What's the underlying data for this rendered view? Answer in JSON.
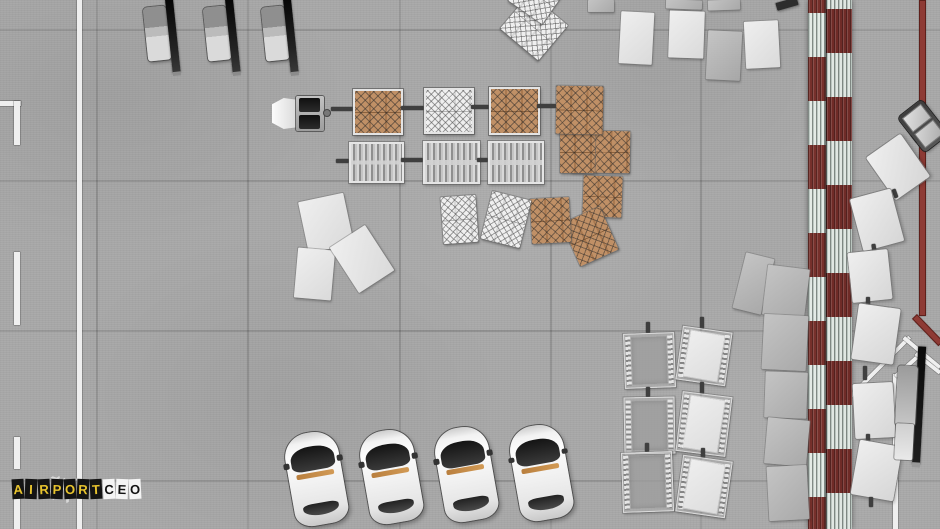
{
  "game": {
    "title_word1": "AIRPORT",
    "title_word2": "CEO"
  },
  "logo": {
    "word1": "AIRPORT",
    "word2": "CEO",
    "tile1_bg": "#141414",
    "tile1_fg": "#e8c42e",
    "tile2_bg": "#f4f4f4",
    "tile2_fg": "#121212",
    "plane_icon": "airplane-icon"
  },
  "colors": {
    "apron_concrete": "#a8a8a8",
    "marking_white": "#efefef",
    "zone_border_red": "#8e3b35",
    "roof_red": "#76302b",
    "roof_panel_white": "#e4ebe6",
    "cargo_brown": "#b98a60",
    "cargo_net": "#3c3c3c",
    "vehicle_belt_black": "#111111",
    "vehicle_silver": "#c6c6c6",
    "car_white": "#f2f2f2",
    "car_trim_amber": "#c68b46"
  },
  "scene": {
    "width": 940,
    "height": 529,
    "seams": {
      "v": [
        96,
        247,
        399,
        550,
        700
      ],
      "h": [
        29,
        180,
        330,
        480
      ]
    },
    "objects": [
      {
        "t": "line_w",
        "x": 77,
        "y": 0,
        "w": 5,
        "h": 529
      },
      {
        "t": "line_w",
        "x": 0,
        "y": 101,
        "w": 21,
        "h": 5
      },
      {
        "t": "line_w",
        "x": 14,
        "y": 101,
        "w": 6,
        "h": 44
      },
      {
        "t": "line_w",
        "x": 14,
        "y": 252,
        "w": 6,
        "h": 73
      },
      {
        "t": "line_w",
        "x": 14,
        "y": 437,
        "w": 6,
        "h": 32
      },
      {
        "t": "line_w",
        "x": 14,
        "y": 498,
        "w": 6,
        "h": 31
      },
      {
        "t": "line_w",
        "x": 845,
        "y": 396,
        "w": 5,
        "h": 133
      },
      {
        "t": "line_w",
        "x": 846,
        "y": 398,
        "w": 88,
        "h": 4,
        "r": -45
      },
      {
        "t": "line_w",
        "x": 905,
        "y": 336,
        "w": 47,
        "h": 4,
        "r": 39.8
      },
      {
        "t": "line_w",
        "x": 893,
        "y": 374,
        "w": 5,
        "h": 155
      },
      {
        "t": "line_w",
        "x": 894,
        "y": 375,
        "w": 35,
        "h": 4,
        "r": -41.5
      },
      {
        "t": "line_w",
        "x": 917,
        "y": 352,
        "w": 31,
        "h": 4,
        "r": 38.4
      },
      {
        "t": "line_r",
        "x": 919,
        "y": 0,
        "w": 7,
        "h": 316
      },
      {
        "t": "line_r",
        "x": 917,
        "y": 314,
        "w": 38,
        "h": 7,
        "r": 46
      },
      {
        "t": "wall",
        "x": 808,
        "y": 0,
        "w": 44,
        "h": 529
      },
      {
        "t": "pallet_plain",
        "v": "gray",
        "x": 588,
        "y": 0,
        "w": 26,
        "h": 12
      },
      {
        "t": "pallet_plain",
        "v": "gray",
        "x": 666,
        "y": 0,
        "w": 36,
        "h": 9,
        "r": 2
      },
      {
        "t": "pallet_plain",
        "v": "gray",
        "x": 708,
        "y": 0,
        "w": 32,
        "h": 10,
        "r": -2
      },
      {
        "t": "pallet_plain",
        "v": "dark",
        "x": 776,
        "y": 0,
        "w": 22,
        "h": 8,
        "r": -16
      },
      {
        "t": "pallet_plain",
        "v": "white",
        "x": 620,
        "y": 12,
        "w": 33,
        "h": 52,
        "r": 3
      },
      {
        "t": "pallet_plain",
        "v": "white",
        "x": 669,
        "y": 11,
        "w": 35,
        "h": 47,
        "r": 2
      },
      {
        "t": "pallet_plain",
        "v": "faint",
        "x": 707,
        "y": 31,
        "w": 34,
        "h": 49,
        "r": 3
      },
      {
        "t": "pallet_plain",
        "v": "white",
        "x": 745,
        "y": 21,
        "w": 34,
        "h": 47,
        "r": -3
      },
      {
        "t": "pallet_plain",
        "v": "gray",
        "x": 739,
        "y": 255,
        "w": 29,
        "h": 57,
        "r": 14
      },
      {
        "t": "pallet_plain",
        "v": "gray",
        "x": 765,
        "y": 267,
        "w": 42,
        "h": 50,
        "r": 7
      },
      {
        "t": "pallet_plain",
        "v": "gray",
        "x": 763,
        "y": 315,
        "w": 44,
        "h": 55,
        "r": 3
      },
      {
        "t": "pallet_plain",
        "v": "gray",
        "x": 765,
        "y": 372,
        "w": 42,
        "h": 46,
        "r": 2
      },
      {
        "t": "pallet_plain",
        "v": "gray",
        "x": 766,
        "y": 419,
        "w": 42,
        "h": 46,
        "r": 5
      },
      {
        "t": "pallet_plain",
        "v": "gray",
        "x": 768,
        "y": 466,
        "w": 40,
        "h": 54,
        "r": -3
      },
      {
        "t": "pallet_plain",
        "v": "white",
        "x": 303,
        "y": 197,
        "w": 46,
        "h": 52,
        "r": -12
      },
      {
        "t": "pallet_plain",
        "v": "white",
        "x": 296,
        "y": 249,
        "w": 37,
        "h": 50,
        "r": 5
      },
      {
        "t": "pallet_plain",
        "v": "white",
        "x": 341,
        "y": 232,
        "w": 42,
        "h": 54,
        "r": -33
      },
      {
        "t": "pallet_plain",
        "v": "white",
        "x": 571,
        "y": 153,
        "w": 23,
        "h": 20,
        "r": 3
      },
      {
        "t": "pallet_net",
        "v": "white",
        "x": 509,
        "y": 4,
        "w": 50,
        "h": 46,
        "r": 40
      },
      {
        "t": "pallet_net",
        "v": "white",
        "x": 516,
        "y": -26,
        "w": 42,
        "h": 42,
        "r": 35
      },
      {
        "t": "pallet_net",
        "v": "brown",
        "x": 560,
        "y": 131,
        "w": 37,
        "h": 42
      },
      {
        "t": "pallet_net",
        "v": "brown",
        "x": 596,
        "y": 131,
        "w": 34,
        "h": 42,
        "r": 1
      },
      {
        "t": "pallet_net",
        "v": "brown",
        "x": 583,
        "y": 176,
        "w": 39,
        "h": 41,
        "r": 2
      },
      {
        "t": "pallet_net",
        "v": "brown",
        "x": 569,
        "y": 213,
        "w": 42,
        "h": 47,
        "r": -24
      },
      {
        "t": "pallet_net",
        "v": "brown",
        "x": 531,
        "y": 198,
        "w": 39,
        "h": 45,
        "r": -3
      },
      {
        "t": "pallet_net",
        "v": "white",
        "x": 442,
        "y": 196,
        "w": 35,
        "h": 47,
        "r": -4
      },
      {
        "t": "pallet_net",
        "v": "white",
        "x": 486,
        "y": 195,
        "w": 40,
        "h": 49,
        "r": 14
      },
      {
        "t": "pallet_net",
        "v": "brown",
        "x": 556,
        "y": 86,
        "w": 47,
        "h": 48,
        "r": 1
      },
      {
        "t": "hitch",
        "x": 331,
        "y": 107,
        "w": 22,
        "h": 4
      },
      {
        "t": "cart_net",
        "v": "brown",
        "x": 353,
        "y": 89,
        "w": 46,
        "h": 42
      },
      {
        "t": "hitch",
        "x": 401,
        "y": 106,
        "w": 23,
        "h": 4
      },
      {
        "t": "cart_net",
        "v": "white",
        "x": 424,
        "y": 88,
        "w": 46,
        "h": 42
      },
      {
        "t": "hitch",
        "x": 471,
        "y": 105,
        "w": 18,
        "h": 4
      },
      {
        "t": "cart_net",
        "v": "brown",
        "x": 489,
        "y": 87,
        "w": 47,
        "h": 44
      },
      {
        "t": "hitch",
        "x": 537,
        "y": 104,
        "w": 19,
        "h": 4
      },
      {
        "t": "tug",
        "x": 272,
        "y": 95,
        "w": 58,
        "h": 37
      },
      {
        "t": "hitch",
        "x": 336,
        "y": 159,
        "w": 13,
        "h": 4
      },
      {
        "t": "cart_slat",
        "x": 349,
        "y": 142,
        "w": 51,
        "h": 37
      },
      {
        "t": "hitch",
        "x": 401,
        "y": 158,
        "w": 22,
        "h": 4
      },
      {
        "t": "cart_slat",
        "x": 423,
        "y": 141,
        "w": 53,
        "h": 39
      },
      {
        "t": "hitch",
        "x": 477,
        "y": 158,
        "w": 11,
        "h": 4
      },
      {
        "t": "cart_slat",
        "x": 488,
        "y": 141,
        "w": 52,
        "h": 39
      },
      {
        "t": "hitch",
        "x": 646,
        "y": 322,
        "w": 4,
        "h": 11
      },
      {
        "t": "cart_frame",
        "v": "gray",
        "x": 624,
        "y": 333,
        "w": 49,
        "h": 53,
        "r": -2
      },
      {
        "t": "hitch",
        "x": 646,
        "y": 387,
        "w": 4,
        "h": 10
      },
      {
        "t": "cart_frame",
        "v": "gray",
        "x": 624,
        "y": 397,
        "w": 49,
        "h": 55,
        "r": -1
      },
      {
        "t": "hitch",
        "x": 645,
        "y": 443,
        "w": 4,
        "h": 9
      },
      {
        "t": "cart_frame",
        "v": "gray",
        "x": 622,
        "y": 452,
        "w": 49,
        "h": 58,
        "r": -2
      },
      {
        "t": "hitch",
        "x": 700,
        "y": 317,
        "w": 4,
        "h": 12
      },
      {
        "t": "cart_frame",
        "v": "white",
        "x": 679,
        "y": 329,
        "w": 48,
        "h": 52,
        "r": 8
      },
      {
        "t": "hitch",
        "x": 700,
        "y": 382,
        "w": 4,
        "h": 12
      },
      {
        "t": "cart_frame",
        "v": "white",
        "x": 679,
        "y": 394,
        "w": 48,
        "h": 58,
        "r": 7
      },
      {
        "t": "hitch",
        "x": 701,
        "y": 448,
        "w": 4,
        "h": 10
      },
      {
        "t": "cart_frame",
        "v": "white",
        "x": 679,
        "y": 458,
        "w": 48,
        "h": 55,
        "r": 8
      },
      {
        "t": "hitch",
        "x": 913,
        "y": 133,
        "w": 4,
        "h": 10,
        "r": -38
      },
      {
        "t": "cart_plain",
        "x": 877,
        "y": 141,
        "w": 42,
        "h": 52,
        "r": -35
      },
      {
        "t": "hitch",
        "x": 893,
        "y": 189,
        "w": 4,
        "h": 9,
        "r": -20
      },
      {
        "t": "cart_plain",
        "x": 856,
        "y": 193,
        "w": 42,
        "h": 54,
        "r": -15
      },
      {
        "t": "hitch",
        "x": 872,
        "y": 244,
        "w": 4,
        "h": 9,
        "r": -8
      },
      {
        "t": "cart_plain",
        "x": 850,
        "y": 251,
        "w": 40,
        "h": 50,
        "r": -6
      },
      {
        "t": "hitch",
        "x": 866,
        "y": 297,
        "w": 4,
        "h": 10
      },
      {
        "t": "cart_plain",
        "x": 855,
        "y": 306,
        "w": 42,
        "h": 56,
        "r": 8
      },
      {
        "t": "hitch",
        "x": 863,
        "y": 366,
        "w": 4,
        "h": 14
      },
      {
        "t": "cart_plain",
        "x": 854,
        "y": 383,
        "w": 40,
        "h": 55,
        "r": -3
      },
      {
        "t": "hitch",
        "x": 866,
        "y": 434,
        "w": 4,
        "h": 10
      },
      {
        "t": "cart_plain",
        "x": 855,
        "y": 443,
        "w": 43,
        "h": 55,
        "r": 10
      },
      {
        "t": "hitch",
        "x": 869,
        "y": 497,
        "w": 4,
        "h": 10
      },
      {
        "t": "tug_tr",
        "x": 908,
        "y": 104,
        "w": 30,
        "h": 44,
        "r": -38
      },
      {
        "t": "belt_loader",
        "x": 146,
        "y": 0,
        "w": 32,
        "h": 76,
        "r": -6
      },
      {
        "t": "belt_loader",
        "x": 206,
        "y": 0,
        "w": 32,
        "h": 76,
        "r": -6
      },
      {
        "t": "belt_loader",
        "x": 264,
        "y": 0,
        "w": 32,
        "h": 76,
        "r": -6
      },
      {
        "t": "belt_loader_long",
        "x": 895,
        "y": 346,
        "w": 30,
        "h": 122,
        "r": 3
      },
      {
        "t": "car",
        "x": 289,
        "y": 432,
        "w": 54,
        "h": 93,
        "r": -10
      },
      {
        "t": "car",
        "x": 364,
        "y": 430,
        "w": 54,
        "h": 93,
        "r": -10
      },
      {
        "t": "car",
        "x": 439,
        "y": 427,
        "w": 54,
        "h": 94,
        "r": -10
      },
      {
        "t": "car",
        "x": 514,
        "y": 425,
        "w": 54,
        "h": 95,
        "r": -10
      }
    ]
  }
}
